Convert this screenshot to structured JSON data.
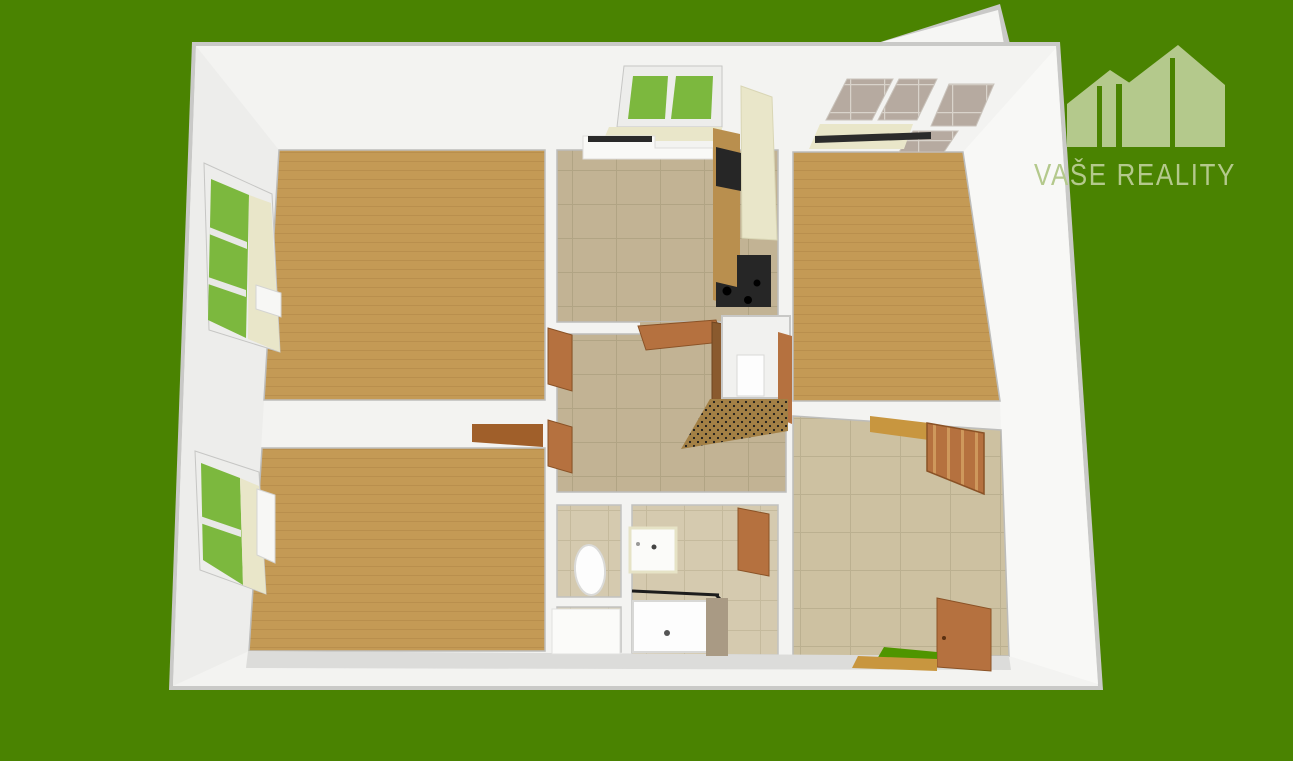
{
  "logo": {
    "text": "VAŠE REALITY",
    "color": "#b4c98c"
  },
  "scene": {
    "background_color": "#4a8301",
    "wall_color": "#f3f3f1",
    "wall_edge_color": "#c9c9c7",
    "left_wall_shade": "#ededeb",
    "right_wall_shade": "#f8f8f6",
    "skirt_gray": "#dcdcda",
    "wood_floor_color": "#c49a55",
    "wood_line_color": "#b08747",
    "kitchen_tile_color": "#c2b394",
    "bath_tile_color": "#d5caaf",
    "room_tile_color": "#cdc1a1",
    "window_green": "#7cb83e",
    "sill_cream": "#e9e6c9",
    "door_brown": "#b5713f",
    "dark_door_brown": "#8a5a2e",
    "open_leaf_brown": "#a05f2a",
    "counter_wood": "#b98f4e",
    "appliance_black": "#262626",
    "balcony_glass": "#b6aaa0",
    "mat_brown": "#a38045",
    "mat_green": "#4f9500",
    "fixture_white": "#fcfcfc",
    "shower_wall_tan": "#a99a84",
    "light_wood_accent": "#c8963f"
  }
}
